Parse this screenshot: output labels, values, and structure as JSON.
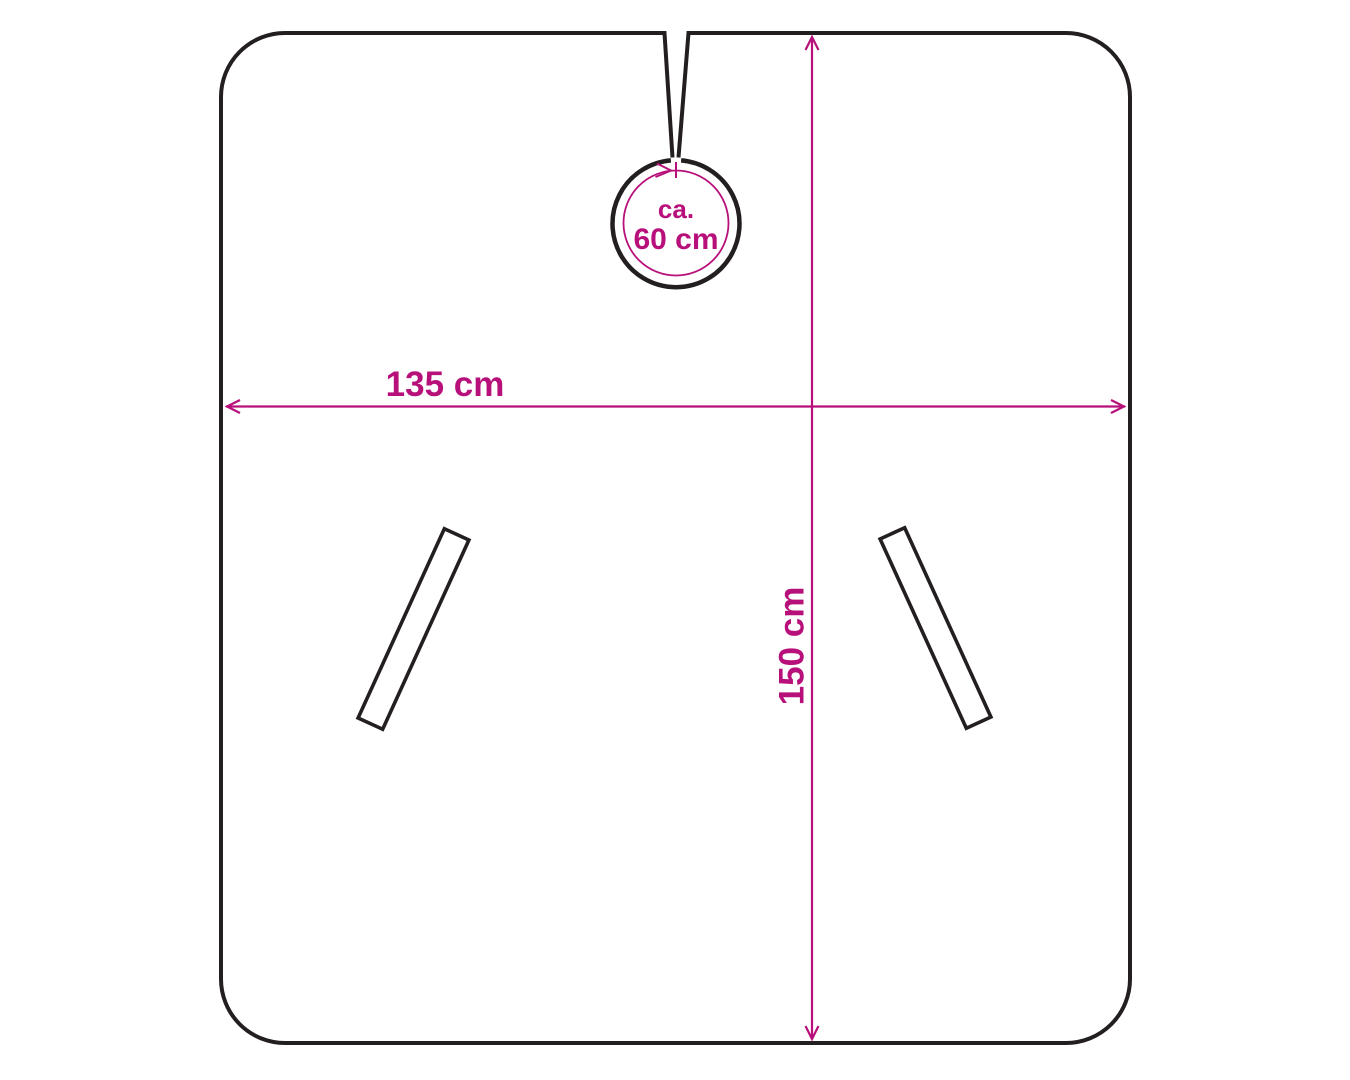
{
  "diagram": {
    "dimensions": {
      "width": {
        "label": "135 cm",
        "value": 135,
        "unit": "cm"
      },
      "height": {
        "label": "150 cm",
        "value": 150,
        "unit": "cm"
      },
      "neck_circumference": {
        "prefix": "ca.",
        "label": "60 cm",
        "value": 60,
        "unit": "cm"
      }
    }
  },
  "colors": {
    "accent": "#b8107a",
    "outline": "#231f20",
    "background": "#ffffff"
  }
}
